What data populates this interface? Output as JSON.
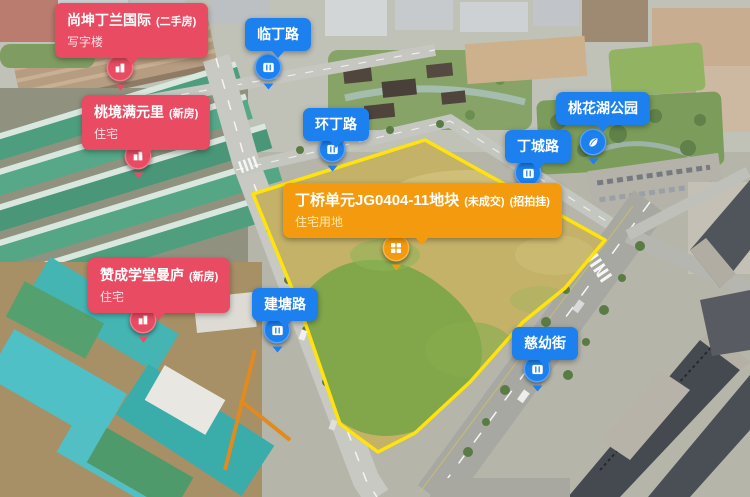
{
  "parcel": {
    "title": "丁桥单元JG0404-11地块",
    "status_tag": "(未成交)",
    "sale_tag": "(招拍挂)",
    "land_use": "住宅用地"
  },
  "properties": [
    {
      "name": "尚坤丁兰国际",
      "tag": "(二手房)",
      "type": "写字楼"
    },
    {
      "name": "桃境满元里",
      "tag": "(新房)",
      "type": "住宅"
    },
    {
      "name": "赞成学堂曼庐",
      "tag": "(新房)",
      "type": "住宅"
    }
  ],
  "roads": [
    {
      "name": "临丁路"
    },
    {
      "name": "环丁路"
    },
    {
      "name": "丁城路"
    },
    {
      "name": "建塘路"
    },
    {
      "name": "慈幼街"
    }
  ],
  "park": {
    "name": "桃花湖公园"
  },
  "colors": {
    "property_bubble": "#e84b62",
    "road_bubble": "#1c80ef",
    "parcel_bubble": "#f49a0e",
    "parcel_outline": "#ffe30a"
  },
  "icons": {
    "property_pin": "building-icon",
    "road_pin": "road-icon",
    "park_pin": "leaf-icon",
    "parcel_pin": "window-grid-icon"
  }
}
